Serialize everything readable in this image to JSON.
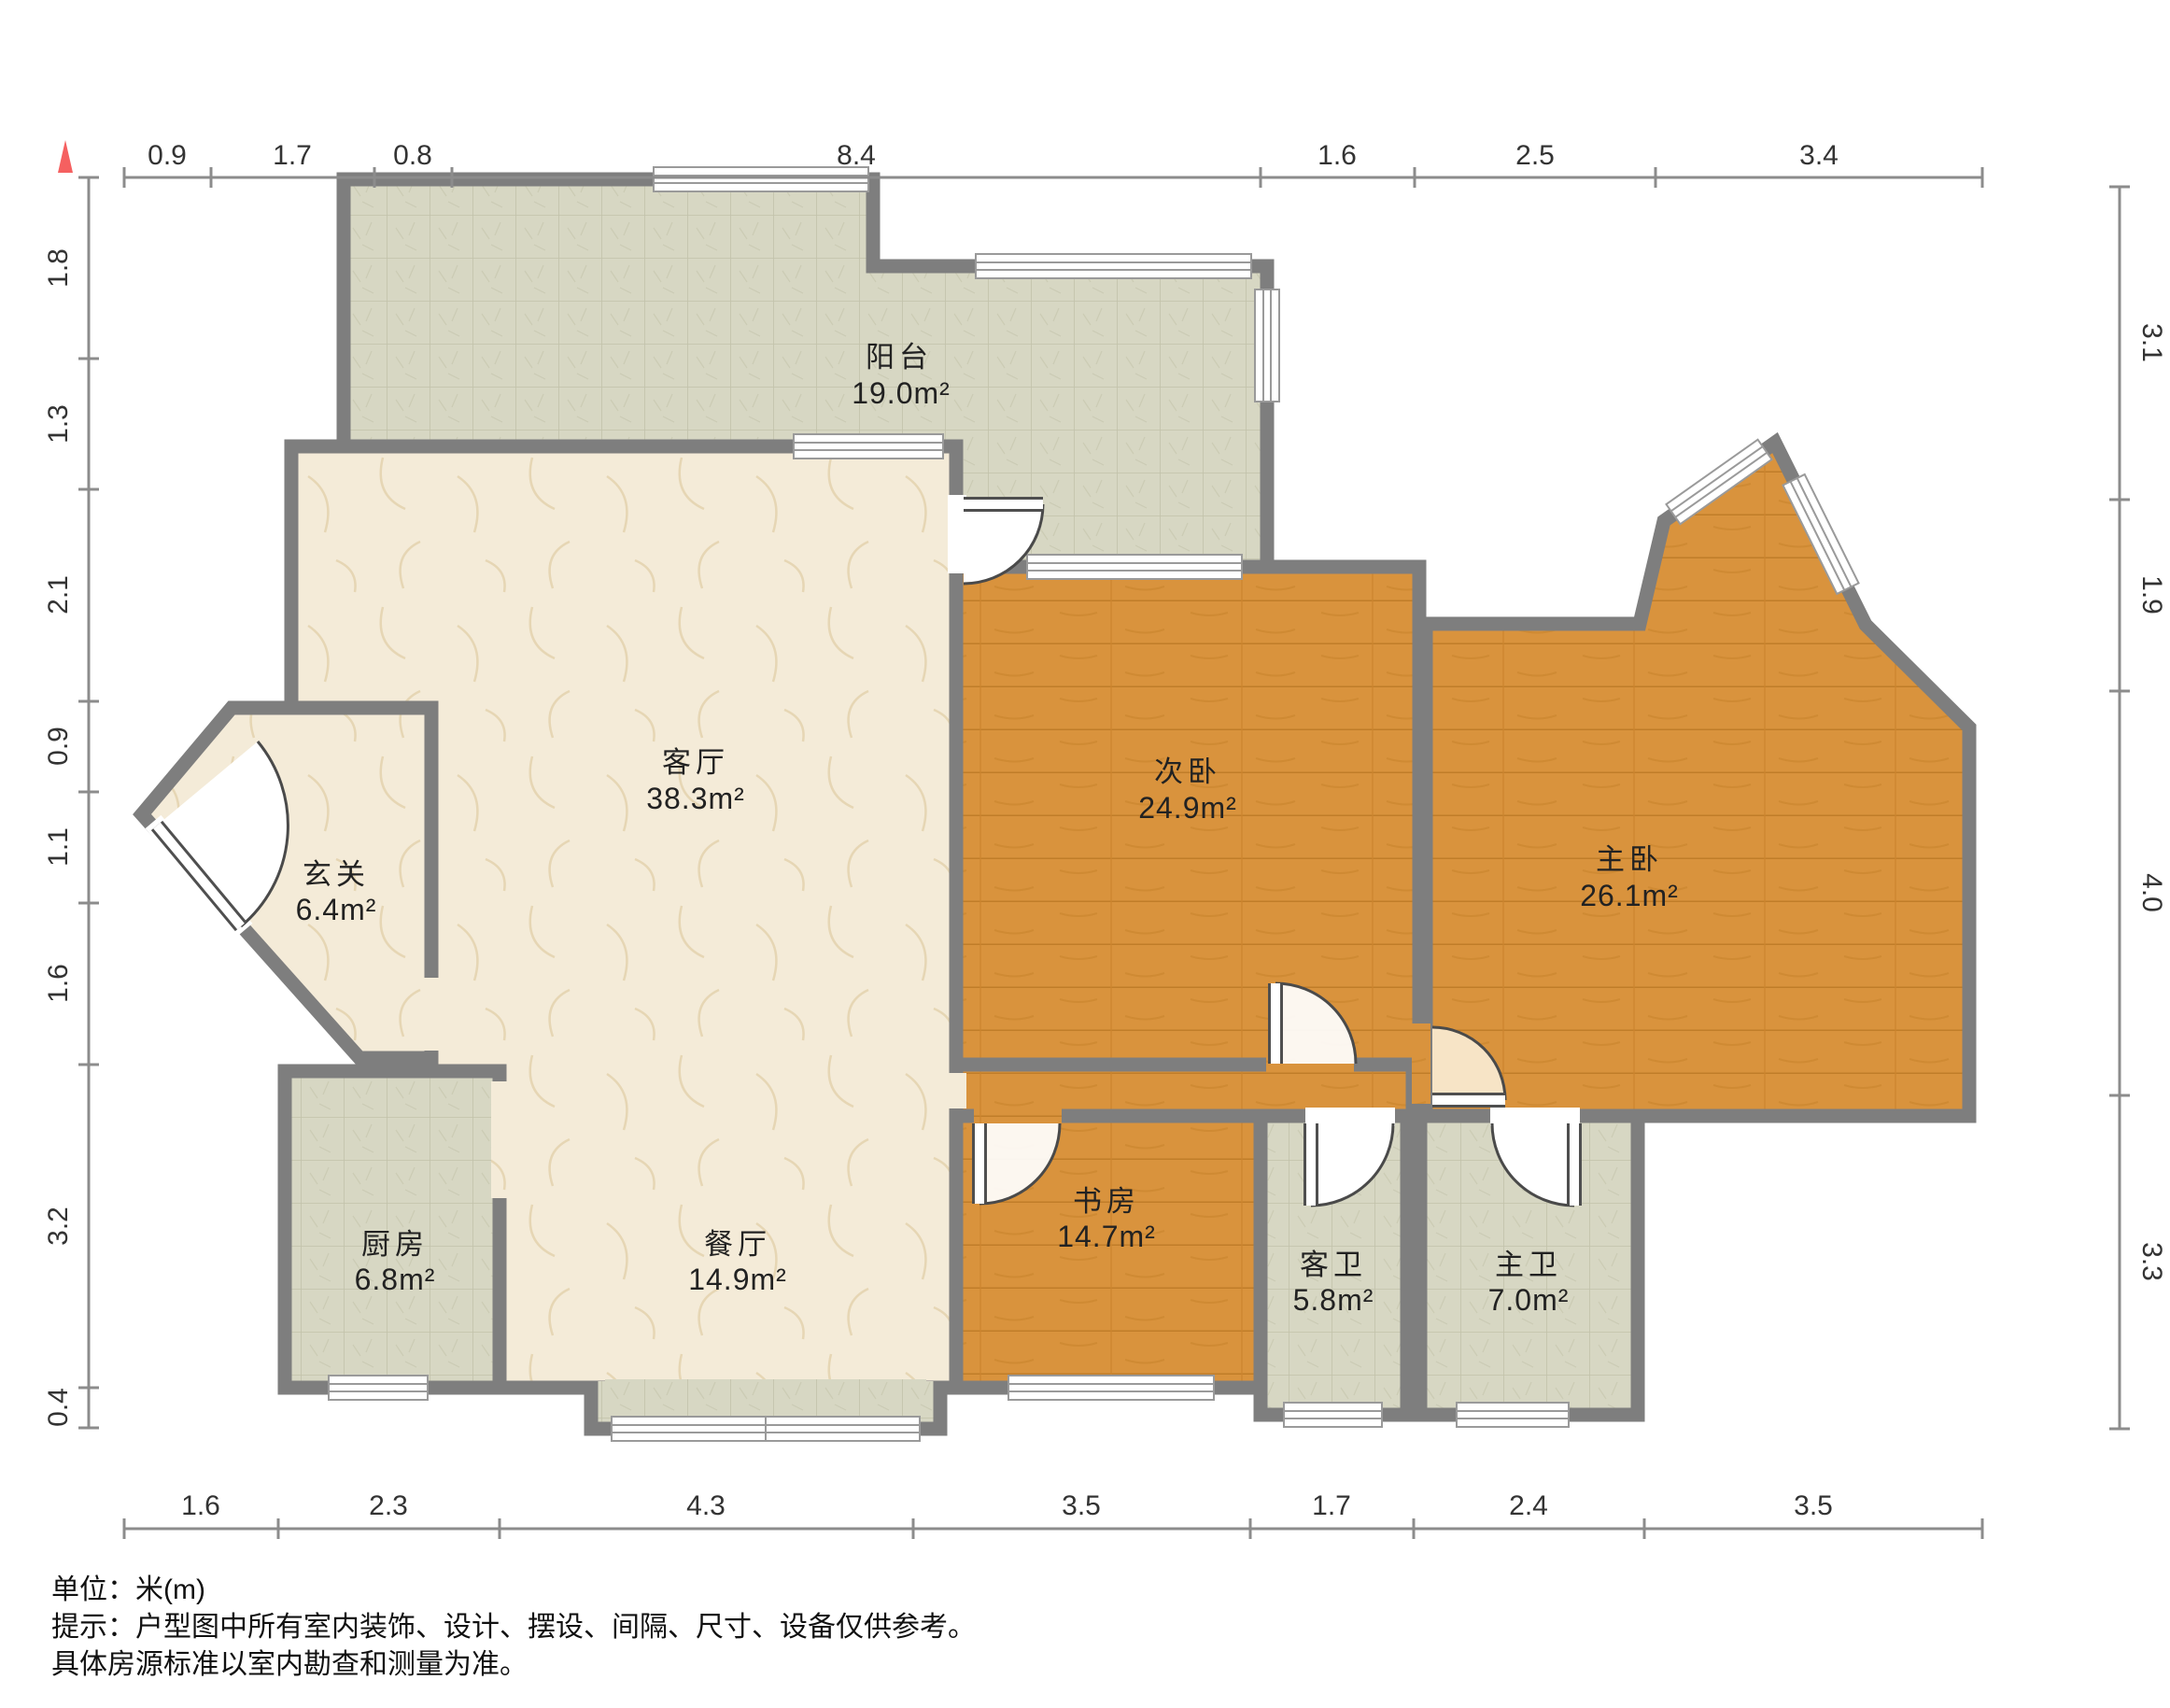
{
  "title": "户型图",
  "unit_note": "单位：米(m)",
  "disclaimer_line1": "提示：户型图中所有室内装饰、设计、摆设、间隔、尺寸、设备仅供参考。",
  "disclaimer_line2": "具体房源标准以室内勘查和测量为准。",
  "colors": {
    "wall": "#7e7e7e",
    "wood_floor": "#d9933d",
    "tile_floor": "#d7d7c3",
    "marble_floor": "#f4ebd8",
    "north_marker": "#f56060",
    "dim_line": "#8c8c8c"
  },
  "rooms": [
    {
      "id": "balcony",
      "name": "阳台",
      "area": "19.0m²",
      "floor": "tile"
    },
    {
      "id": "living",
      "name": "客厅",
      "area": "38.3m²",
      "floor": "marble"
    },
    {
      "id": "entry",
      "name": "玄关",
      "area": "6.4m²",
      "floor": "marble"
    },
    {
      "id": "kitchen",
      "name": "厨房",
      "area": "6.8m²",
      "floor": "tile"
    },
    {
      "id": "dining",
      "name": "餐厅",
      "area": "14.9m²",
      "floor": "marble"
    },
    {
      "id": "bedroom2",
      "name": "次卧",
      "area": "24.9m²",
      "floor": "wood"
    },
    {
      "id": "study",
      "name": "书房",
      "area": "14.7m²",
      "floor": "wood"
    },
    {
      "id": "guest-bath",
      "name": "客卫",
      "area": "5.8m²",
      "floor": "tile"
    },
    {
      "id": "master-bath",
      "name": "主卫",
      "area": "7.0m²",
      "floor": "tile"
    },
    {
      "id": "master-bedroom",
      "name": "主卧",
      "area": "26.1m²",
      "floor": "wood"
    }
  ],
  "dims": {
    "top": [
      "0.9",
      "1.7",
      "0.8",
      "8.4",
      "1.6",
      "2.5",
      "3.4"
    ],
    "bottom": [
      "1.6",
      "2.3",
      "4.3",
      "3.5",
      "1.7",
      "2.4",
      "3.5"
    ],
    "left": [
      "1.8",
      "1.3",
      "2.1",
      "0.9",
      "1.1",
      "1.6",
      "3.2",
      "0.4"
    ],
    "right": [
      "3.1",
      "1.9",
      "4.0",
      "3.3"
    ]
  }
}
